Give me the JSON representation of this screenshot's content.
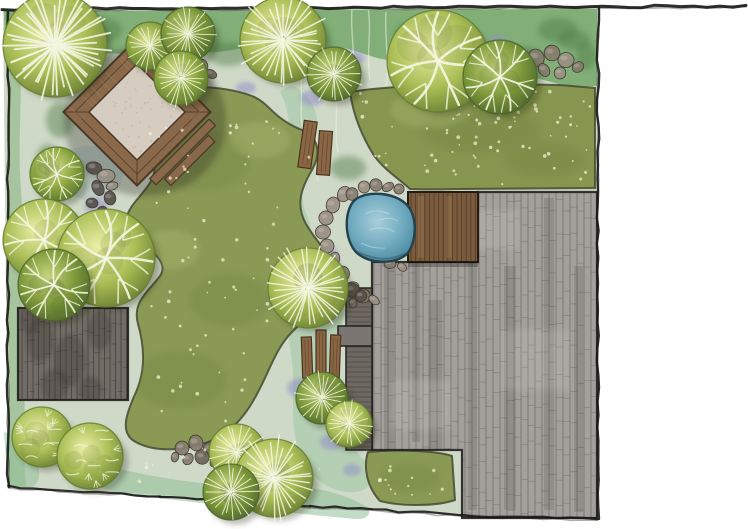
{
  "meta": {
    "visible_text": "none",
    "subject": "hand-rendered garden landscape plan, top view"
  },
  "canvas": {
    "w": 748,
    "h": 529
  },
  "colors": {
    "paper": "#ffffff",
    "ink": "#1b1a17",
    "fern": "#4f7a44",
    "purple": "#928fc6",
    "lawn": "#8a9a55",
    "lawnRight": "#87964f",
    "lawnEdge": "#454a33",
    "lawnDark": "#6e7f41",
    "lawnLight": "#b9c37c",
    "patio": "#a3a09b",
    "patioLine": "#57534f",
    "patioDark": "#34312e",
    "patioLight": "#d6d3cf",
    "patioEdge": "#232120",
    "paved": "#716c66",
    "pavedLine": "#3e3a35",
    "strip": "#6d6862",
    "deck": "#7b5b3d",
    "deckLine": "#42301d",
    "deckLight": "#96744e",
    "deckEdge": "#241b11",
    "pondEdge": "#24414d",
    "ripple": "#dceef2",
    "stone": "#8a6644",
    "stoneEdge": "#4a3420",
    "rockTones": [
      "#9a9083",
      "#867c6e",
      "#6d6459",
      "#55504a"
    ],
    "wood": "#8a684a",
    "woodDark": "#4c3826",
    "gravel": "#d6cdc0",
    "vein": "#f4f7e3",
    "shadow": "#20260f",
    "treeTones": [
      [
        "#55702c",
        "#8aa53e",
        "#dce393"
      ],
      [
        "#63792f",
        "#a9bd55",
        "#ecf0a8"
      ],
      [
        "#49632a",
        "#7c9739",
        "#c8d67e"
      ]
    ]
  },
  "scene": {
    "base_paths": [
      {
        "name": "plan-base",
        "d": "M3,10 L598,8 L598,519 L462,516 L300,505 L150,494 L8,487 Z",
        "fill": "#cfd9c8",
        "opacity": 1
      },
      {
        "name": "top-planting-band",
        "d": "M4,11 L597,9 L597,86 C556,92 522,66 488,72 C454,78 436,56 404,60 C372,64 352,42 322,48 C292,54 262,44 232,50 C202,56 172,48 142,52 C112,56 82,50 52,58 C32,62 14,58 5,52 Z",
        "fill": "#7bab70",
        "opacity": 0.92
      },
      {
        "name": "left-margin-wash",
        "d": "M4,48 C12,80 8,130 9,180 C10,240 7,300 9,360 C10,410 7,450 9,487 L26,488 C22,440 27,390 23,340 C19,290 25,240 21,190 C17,140 23,95 20,56 Z",
        "fill": "#85b27b",
        "opacity": 0.55
      },
      {
        "name": "center-path-wash",
        "d": "M300,90 C318,104 322,126 312,150 C302,174 298,196 308,218 C314,232 310,246 298,250 C282,254 272,240 276,222 C282,198 280,174 286,150 C292,126 288,106 280,92 C286,86 294,84 300,90 Z",
        "fill": "#9cc6a0",
        "opacity": 0.5
      },
      {
        "name": "center-bottom-wash",
        "d": "M300,252 C330,260 346,282 344,310 C342,340 330,368 334,398 C338,428 352,448 366,462 C378,474 372,490 356,492 C330,494 310,478 300,454 C288,424 296,392 292,362 C288,332 284,300 288,276 C290,262 294,254 300,252 Z",
        "fill": "#9cc6a0",
        "opacity": 0.5
      },
      {
        "name": "bottom-band-wash",
        "d": "M56,452 C120,472 200,488 270,486 C320,485 350,496 368,508 C372,514 366,520 356,519 C300,514 210,504 140,496 C100,491 70,476 50,462 Z",
        "fill": "#8fbf98",
        "opacity": 0.55
      },
      {
        "name": "bottom-left-wash",
        "d": "M4,432 C20,436 34,448 38,464 C42,480 36,490 22,488 L8,487 Z",
        "fill": "#8fbf98",
        "opacity": 0.5
      },
      {
        "name": "pergola-area-wash",
        "d": "M70,150 C90,142 112,146 120,160 C128,174 120,192 104,198 C88,204 70,198 64,184 C58,170 60,156 70,150 Z",
        "fill": "#9db8c0",
        "opacity": 0.35
      }
    ],
    "fern_blobs": [
      [
        96,
        30,
        26,
        14
      ],
      [
        228,
        54,
        22,
        12
      ],
      [
        330,
        66,
        24,
        12
      ],
      [
        420,
        34,
        26,
        13
      ],
      [
        520,
        58,
        24,
        12
      ],
      [
        574,
        40,
        16,
        10
      ],
      [
        262,
        30,
        18,
        10
      ],
      [
        160,
        36,
        18,
        10
      ],
      [
        348,
        168,
        18,
        12
      ],
      [
        60,
        120,
        14,
        18
      ],
      [
        48,
        160,
        12,
        16
      ],
      [
        558,
        30,
        20,
        12
      ],
      [
        586,
        56,
        10,
        14
      ]
    ],
    "purple_patches": [
      [
        60,
        84,
        18,
        10
      ],
      [
        96,
        206,
        12,
        8
      ],
      [
        40,
        298,
        11,
        7
      ],
      [
        246,
        88,
        10,
        6
      ],
      [
        312,
        98,
        12,
        8
      ],
      [
        352,
        58,
        13,
        8
      ],
      [
        390,
        124,
        10,
        7
      ],
      [
        412,
        86,
        9,
        6
      ],
      [
        330,
        258,
        9,
        11
      ],
      [
        326,
        312,
        13,
        9
      ],
      [
        302,
        388,
        15,
        10
      ],
      [
        332,
        442,
        12,
        8
      ],
      [
        352,
        470,
        9,
        6
      ],
      [
        300,
        470,
        10,
        7
      ],
      [
        560,
        92,
        10,
        6
      ],
      [
        498,
        42,
        11,
        7
      ]
    ],
    "white_streaks": [
      "M352,10 C350,32 356,54 352,78",
      "M368,8 C372,30 366,54 370,80",
      "M386,12 C384,36 390,62 386,86",
      "M300,72 C304,92 298,114 304,134",
      "M316,122 C318,142 314,162 318,182",
      "M336,96 C338,116 334,134 338,152"
    ],
    "lawns": {
      "left": {
        "d": "M130,98 C160,86 215,82 252,96 C270,103 272,118 302,130 C318,137 322,152 312,170 C300,190 296,206 306,224 C320,248 334,254 332,278 C330,302 310,314 292,332 C276,348 270,370 258,392 C246,416 232,432 208,442 C182,452 152,452 134,441 C120,432 126,414 136,392 C144,374 146,352 138,324 C132,302 148,292 160,276 C168,264 156,252 136,242 C120,234 124,218 132,206 C142,192 158,180 154,162 C150,148 134,144 130,128 C127,114 124,102 130,98 Z"
      },
      "right": {
        "d": "M350,92 C392,85 470,83 560,85 L595,88 L595,188 L462,189 C448,189 428,190 410,189 C398,178 382,168 373,154 C362,136 353,114 350,92 Z"
      },
      "corner": {
        "d": "M368,452 C398,449 438,451 452,456 L455,500 C438,506 402,507 380,501 C367,487 363,467 368,452 Z"
      }
    },
    "lawn_mottle": [
      [
        200,
        160,
        50,
        30,
        "d",
        "clipLL"
      ],
      [
        230,
        300,
        40,
        26,
        "d",
        "clipLL"
      ],
      [
        180,
        380,
        46,
        28,
        "d",
        "clipLL"
      ],
      [
        480,
        130,
        60,
        24,
        "d",
        "clipLR"
      ],
      [
        545,
        160,
        40,
        18,
        "d",
        "clipLR"
      ],
      [
        410,
        478,
        30,
        14,
        "d",
        "clipLC"
      ],
      [
        260,
        140,
        30,
        18,
        "l",
        "clipLL"
      ],
      [
        170,
        250,
        30,
        20,
        "l",
        "clipLL"
      ],
      [
        430,
        110,
        40,
        18,
        "l",
        "clipLR"
      ]
    ],
    "paved_left": {
      "x": 18,
      "y": 308,
      "w": 110,
      "h": 92
    },
    "paved_blotches": [
      [
        40,
        340,
        14,
        22
      ],
      [
        70,
        360,
        16,
        26
      ],
      [
        100,
        330,
        12,
        20
      ],
      [
        55,
        385,
        14,
        16
      ],
      [
        90,
        390,
        12,
        14
      ],
      [
        30,
        320,
        10,
        14
      ]
    ],
    "patio": {
      "points": "372,262 478,262 478,192 597,192 597,518 462,518 462,450 372,450",
      "streaks": [
        [
          384,
          262,
          10,
          248
        ],
        [
          428,
          300,
          14,
          210
        ],
        [
          468,
          200,
          9,
          310
        ],
        [
          504,
          266,
          12,
          244
        ],
        [
          544,
          198,
          10,
          312
        ],
        [
          574,
          266,
          9,
          246
        ],
        [
          412,
          262,
          8,
          180
        ]
      ],
      "lights": [
        [
          440,
          210,
          80,
          40
        ],
        [
          500,
          330,
          70,
          60
        ],
        [
          390,
          380,
          60,
          50
        ]
      ]
    },
    "strip": {
      "x": 346,
      "y": 288,
      "w": 26,
      "h": 162
    },
    "step_block": {
      "x": 338,
      "y": 326,
      "w": 34,
      "h": 20
    },
    "deck": {
      "x": 408,
      "y": 192,
      "w": 70,
      "h": 70,
      "lights": [
        [
          418,
          196,
          6,
          62
        ],
        [
          447,
          196,
          5,
          62
        ]
      ]
    },
    "pond": {
      "d": "M356,199 C370,190 394,193 406,204 C418,215 417,242 407,254 C394,265 370,264 357,253 C344,241 343,209 356,199 Z",
      "stream_d": "M330,252 C336,270 334,292 326,308 C320,320 308,322 304,312 C300,300 308,286 312,270 C316,256 322,248 330,252 Z",
      "ripples": [
        "M365,214 q12,-6 24,0",
        "M369,230 q14,-5 26,2",
        "M361,243 q12,6 24,5",
        "M380,220 q10,-4 18,1"
      ],
      "dark_arc": "M358,252 q26,13 48,1"
    },
    "pond_rocks": [
      [
        344,
        194,
        8
      ],
      [
        333,
        205,
        8
      ],
      [
        326,
        218,
        7
      ],
      [
        323,
        232,
        7
      ],
      [
        327,
        246,
        7
      ],
      [
        334,
        260,
        8
      ],
      [
        342,
        274,
        8
      ],
      [
        352,
        287,
        7
      ],
      [
        363,
        296,
        7
      ],
      [
        374,
        300,
        6
      ],
      [
        352,
        194,
        6
      ],
      [
        364,
        187,
        6
      ],
      [
        376,
        185,
        6
      ],
      [
        388,
        187,
        6
      ],
      [
        399,
        189,
        5
      ],
      [
        390,
        264,
        6
      ],
      [
        402,
        267,
        5
      ]
    ],
    "rock_clusters": [
      {
        "name": "pergola-rocks",
        "tone": 3,
        "boulders": [
          [
            94,
            168,
            8
          ],
          [
            106,
            176,
            9
          ],
          [
            98,
            188,
            8
          ],
          [
            110,
            198,
            7
          ],
          [
            92,
            203,
            6
          ],
          [
            102,
            212,
            6
          ],
          [
            112,
            186,
            6
          ]
        ]
      },
      {
        "name": "top-right-rocks",
        "tone": 0,
        "boulders": [
          [
            536,
            58,
            9
          ],
          [
            552,
            53,
            8
          ],
          [
            566,
            60,
            8
          ],
          [
            578,
            67,
            6
          ],
          [
            544,
            70,
            7
          ],
          [
            560,
            73,
            6
          ]
        ]
      },
      {
        "name": "bottom-rocks",
        "tone": 1,
        "boulders": [
          [
            182,
            448,
            7
          ],
          [
            196,
            443,
            8
          ],
          [
            210,
            449,
            7
          ],
          [
            188,
            459,
            6
          ],
          [
            202,
            457,
            7
          ],
          [
            214,
            462,
            5
          ],
          [
            175,
            457,
            5
          ],
          [
            220,
            455,
            5
          ]
        ]
      },
      {
        "name": "top-center-rocks",
        "tone": 1,
        "boulders": [
          [
            201,
            66,
            7
          ],
          [
            211,
            74,
            6
          ],
          [
            195,
            77,
            5
          ]
        ]
      },
      {
        "name": "patio-corner-rocks",
        "tone": 2,
        "boulders": [
          [
            352,
            290,
            7
          ],
          [
            361,
            296,
            6
          ],
          [
            353,
            303,
            5
          ]
        ]
      }
    ],
    "pergola": {
      "cx": 137,
      "cy": 112,
      "rot": 45,
      "outer": 104,
      "frame": 18,
      "rail_rects": [
        [
          56,
          -46,
          9,
          84
        ],
        [
          67,
          -34,
          9,
          62
        ]
      ]
    },
    "planks": [
      {
        "x": 301,
        "y": 121,
        "w": 13,
        "h": 47,
        "rot": 8
      },
      {
        "x": 318,
        "y": 131,
        "w": 13,
        "h": 44,
        "rot": 4
      },
      {
        "x": 302,
        "y": 337,
        "w": 10,
        "h": 41,
        "rot": -2
      },
      {
        "x": 316,
        "y": 330,
        "w": 10,
        "h": 47,
        "rot": 0
      },
      {
        "x": 330,
        "y": 335,
        "w": 10,
        "h": 43,
        "rot": 2
      }
    ],
    "specks": [
      {
        "x": 150,
        "y": 100,
        "w": 160,
        "h": 330,
        "n": 80,
        "clip": "clipLL"
      },
      {
        "x": 360,
        "y": 90,
        "w": 230,
        "h": 95,
        "n": 55,
        "clip": "clipLR"
      },
      {
        "x": 430,
        "y": 95,
        "w": 160,
        "h": 80,
        "n": 25,
        "clip": "clipLR"
      },
      {
        "x": 370,
        "y": 454,
        "w": 80,
        "h": 46,
        "n": 14,
        "clip": "clipLC"
      },
      {
        "x": 60,
        "y": 446,
        "w": 280,
        "h": 42,
        "n": 20,
        "clip": null
      }
    ],
    "margin_right": {
      "x": 599,
      "y": 0,
      "w": 149,
      "h": 529
    },
    "borders": [
      {
        "x1": 2,
        "y1": 9,
        "x2": 746,
        "y2": 6,
        "w": 3
      },
      {
        "x1": 598,
        "y1": 8,
        "x2": 598,
        "y2": 519,
        "w": 2.4
      },
      {
        "x1": 8,
        "y1": 12,
        "x2": 8,
        "y2": 487,
        "w": 2.4
      },
      {
        "x1": 8,
        "y1": 487,
        "x2": 160,
        "y2": 496,
        "w": 2.2
      },
      {
        "x1": 160,
        "y1": 496,
        "x2": 310,
        "y2": 506,
        "w": 2.2
      },
      {
        "x1": 310,
        "y1": 506,
        "x2": 462,
        "y2": 515,
        "w": 2.2
      },
      {
        "x1": 462,
        "y1": 515,
        "x2": 597,
        "y2": 519,
        "w": 2.4
      }
    ],
    "trees": [
      [
        55,
        45,
        52,
        "radial",
        1
      ],
      [
        150,
        46,
        24,
        "radial",
        0
      ],
      [
        188,
        34,
        27,
        "radial",
        2
      ],
      [
        181,
        78,
        27,
        "radial",
        0
      ],
      [
        283,
        40,
        43,
        "radial",
        1
      ],
      [
        334,
        74,
        27,
        "radial",
        2
      ],
      [
        438,
        61,
        51,
        "branch",
        1
      ],
      [
        500,
        77,
        37,
        "branch",
        2
      ],
      [
        57,
        174,
        27,
        "branch",
        0
      ],
      [
        44,
        240,
        41,
        "branch",
        1
      ],
      [
        106,
        258,
        49,
        "branch",
        1
      ],
      [
        54,
        285,
        36,
        "branch",
        2
      ],
      [
        308,
        288,
        40,
        "radial",
        1
      ],
      [
        322,
        398,
        26,
        "radial",
        2
      ],
      [
        349,
        424,
        23,
        "radial",
        1
      ],
      [
        237,
        452,
        28,
        "radial",
        1
      ],
      [
        274,
        478,
        39,
        "radial",
        1
      ],
      [
        231,
        492,
        28,
        "radial",
        2
      ],
      [
        42,
        437,
        30,
        "leafy",
        1
      ],
      [
        90,
        456,
        33,
        "leafy",
        1
      ]
    ]
  }
}
